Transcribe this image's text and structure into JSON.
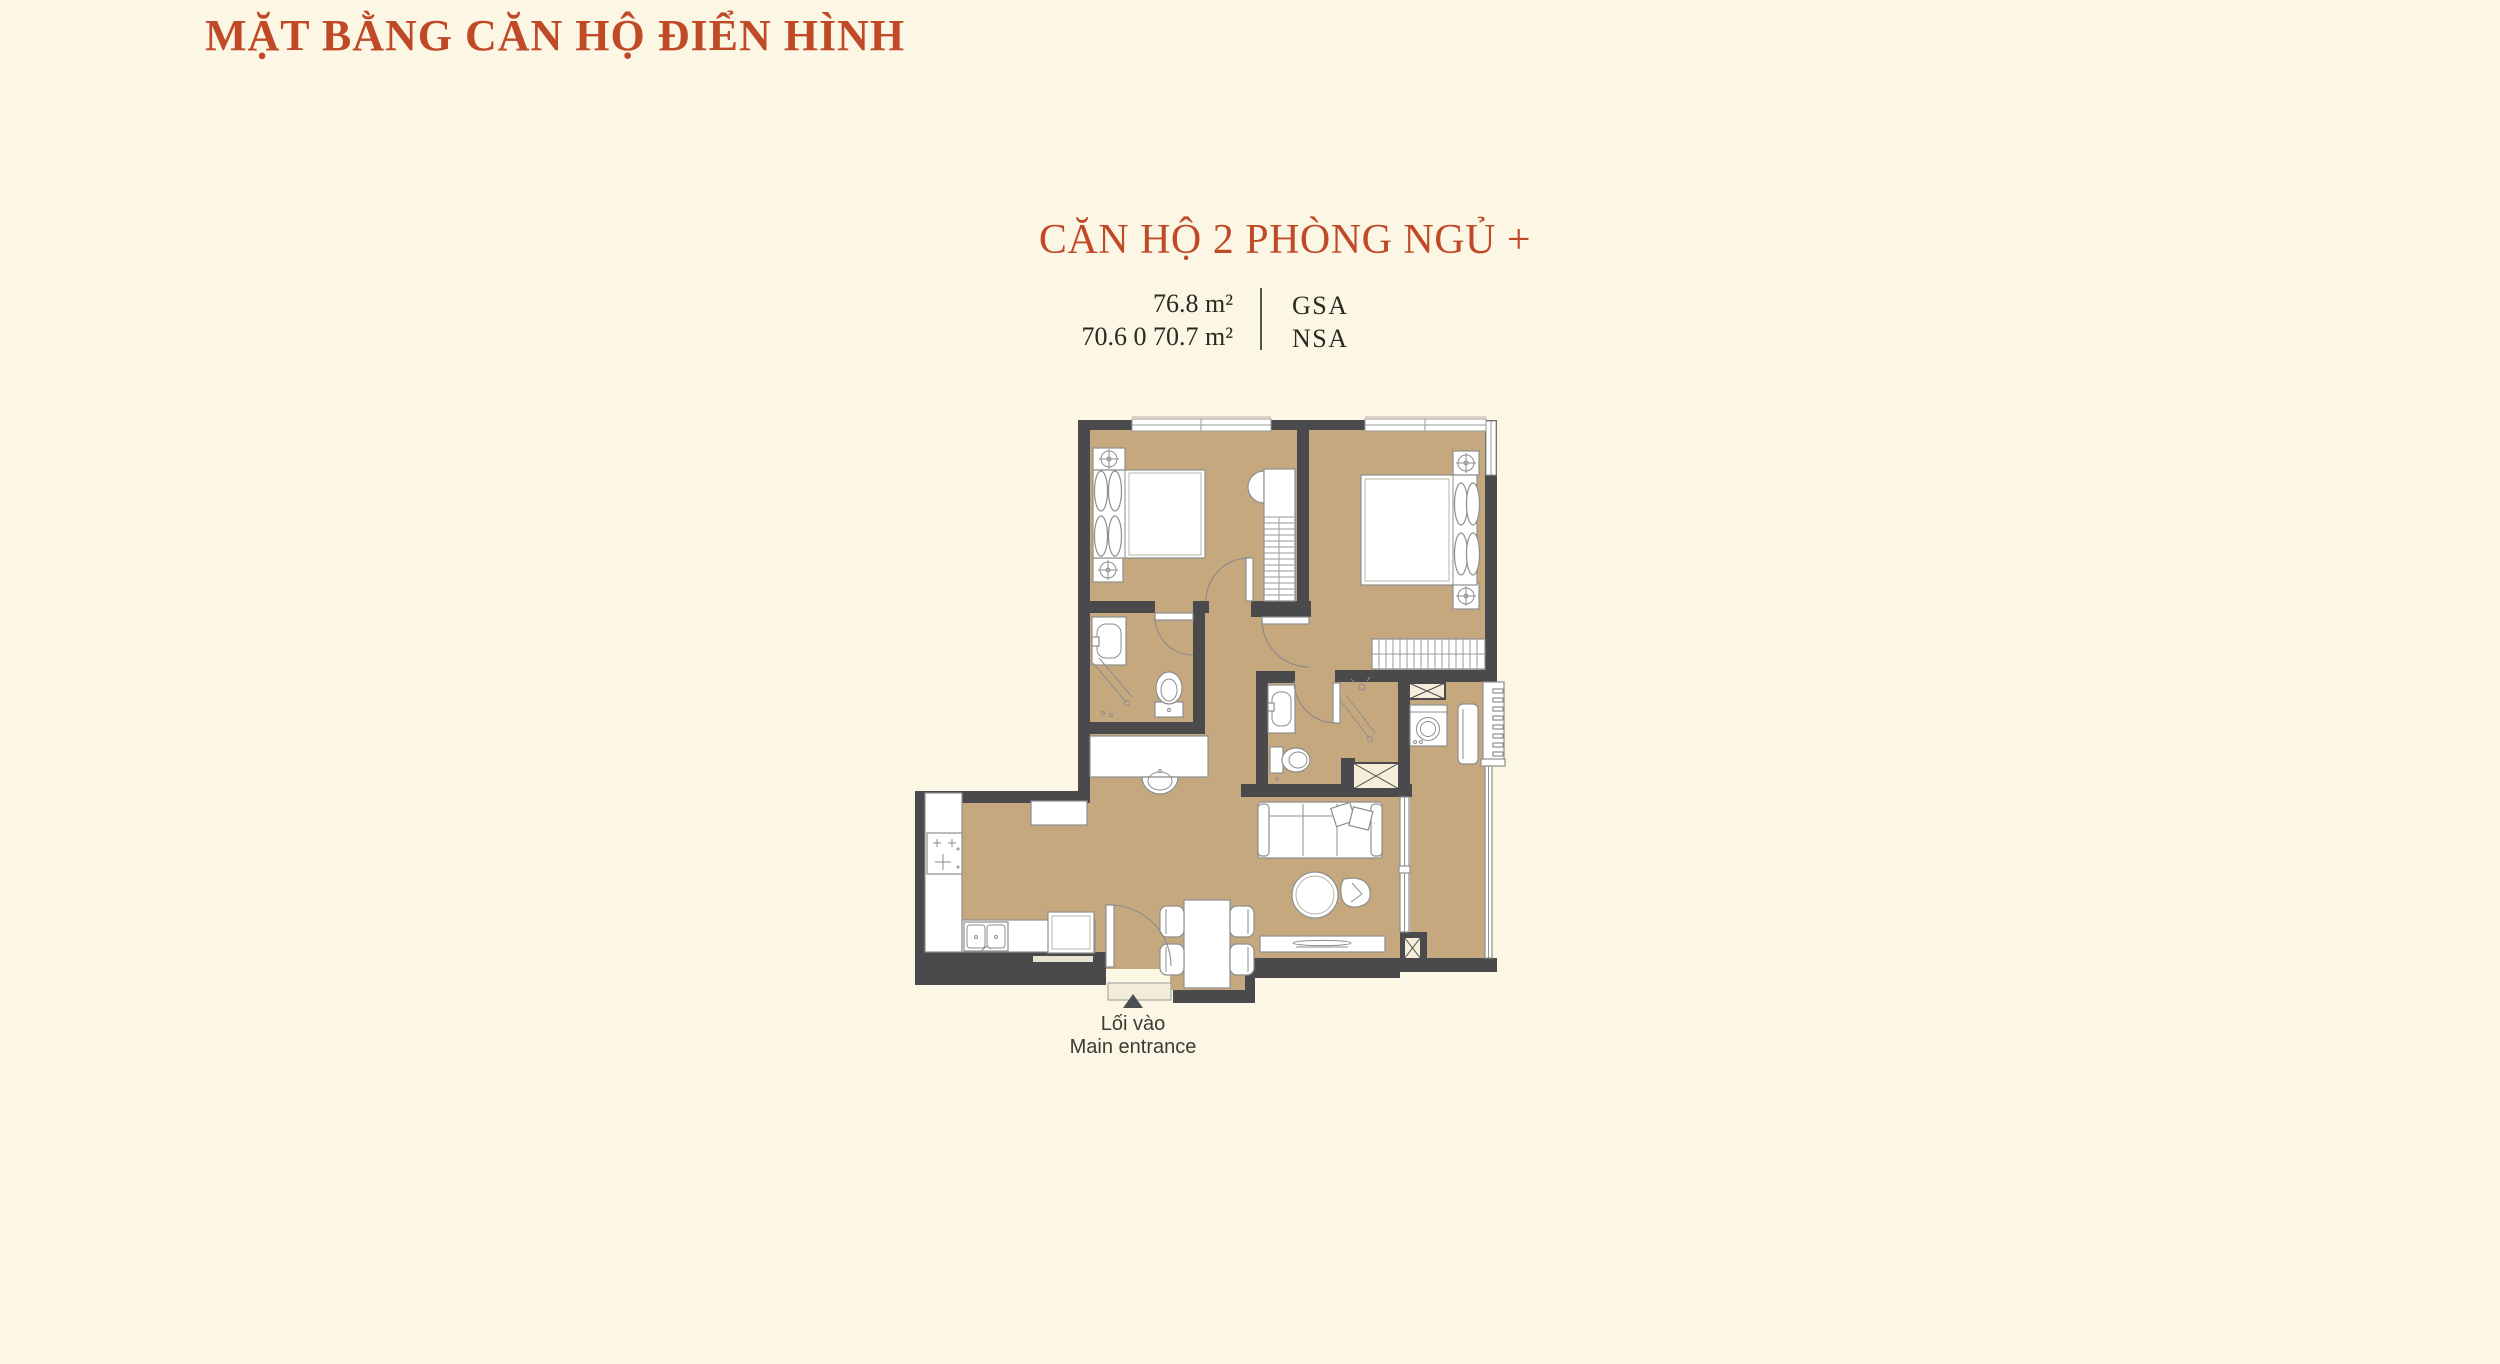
{
  "page": {
    "background": "#fcf6e4"
  },
  "title": {
    "text": "MẶT BẰNG CĂN HỘ ĐIỂN HÌNH",
    "color": "#c04a28"
  },
  "unit": {
    "heading": "CĂN HỘ 2 PHÒNG NGỦ +",
    "heading_color": "#c04a28",
    "specs": [
      {
        "value": "76.8 m²",
        "label": "GSA"
      },
      {
        "value": "70.6 0 70.7 m²",
        "label": "NSA"
      }
    ]
  },
  "floorplan": {
    "colors": {
      "floor": "#c5a87e",
      "wall": "#4a4a4c",
      "fixture_stroke": "#8e8e8e",
      "shaft_fill": "#f6eedb",
      "background": "#fcf6e4"
    },
    "entrance": {
      "line1": "Lối vào",
      "line2": "Main entrance",
      "marker": "up-triangle",
      "marker_color": "#4b4e52"
    }
  }
}
